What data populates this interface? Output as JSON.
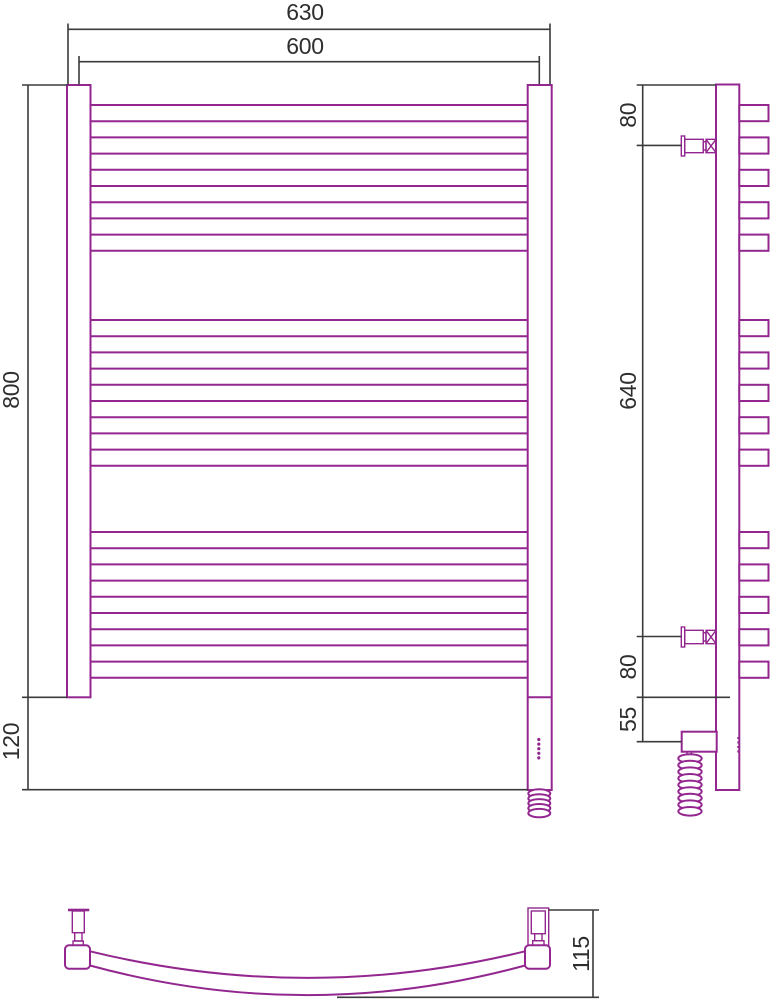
{
  "page": {
    "background": "#ffffff"
  },
  "colors": {
    "drawing": "#93278F",
    "dimension": "#3b3b3d",
    "text": "#2e2e30"
  },
  "drawing": {
    "type": "technical-dimension-drawing",
    "subject": "curved electric heated towel rail with three rung groups, wall brackets and heating element with coiled cable",
    "views": {
      "front": {
        "name": "front view",
        "tube_groups": 3,
        "tubes_per_group": 5,
        "labels": {
          "width_overall": "630",
          "width_mounting": "600",
          "height": "800",
          "heater_drop": "120"
        }
      },
      "side": {
        "name": "side view",
        "labels": {
          "top_to_bracket": "80",
          "bracket_spacing": "640",
          "bracket_to_bottom": "80",
          "bottom_to_heater": "55"
        }
      },
      "bottom": {
        "name": "bottom view",
        "labels": {
          "depth": "115"
        }
      }
    }
  }
}
